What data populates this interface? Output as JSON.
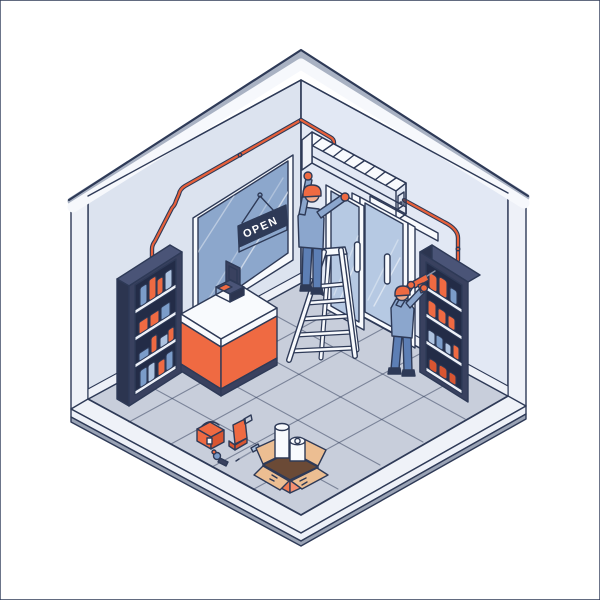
{
  "illustration": {
    "sign": {
      "label": "OPEN"
    },
    "palette": {
      "line": "#2e3a57",
      "wallLeft": "#dce3ef",
      "wallRight": "#e2e8f4",
      "bandTrim": "#a9b2c3",
      "bandFace": "#f6f8fc",
      "endFace": "#eef1f8",
      "floor": "#c8cedb",
      "curb": "#eff2f8",
      "slabRim": "#9aa3b5",
      "windowGlass": "#8ca7cc",
      "doorGlass": "#b6c9e3",
      "white": "#f8fafd",
      "orange": "#ef6a42",
      "orangeDeep": "#d85531",
      "cable": "#e8603a",
      "furnitureDark": "#39415f",
      "furnitureDarker": "#2c3550",
      "furnitureTop": "#4a5477",
      "opening": "#232c47",
      "shelfBoard": "#eef1f8",
      "itemBlue": "#7b9cc9",
      "itemBlueLight": "#aec3e0",
      "cardboard": "#ecbe92",
      "boxSalmon": "#ef7a52",
      "boxSalmonLight": "#f49071",
      "boxInterior": "#6b4a36",
      "skin": "#f2ab8c",
      "shirt": "#8ba6cd",
      "pants": "#5d7fb5",
      "signNavy": "#2e3a57",
      "acShade": "#e8edf6",
      "metal": "#8a93a8"
    }
  }
}
